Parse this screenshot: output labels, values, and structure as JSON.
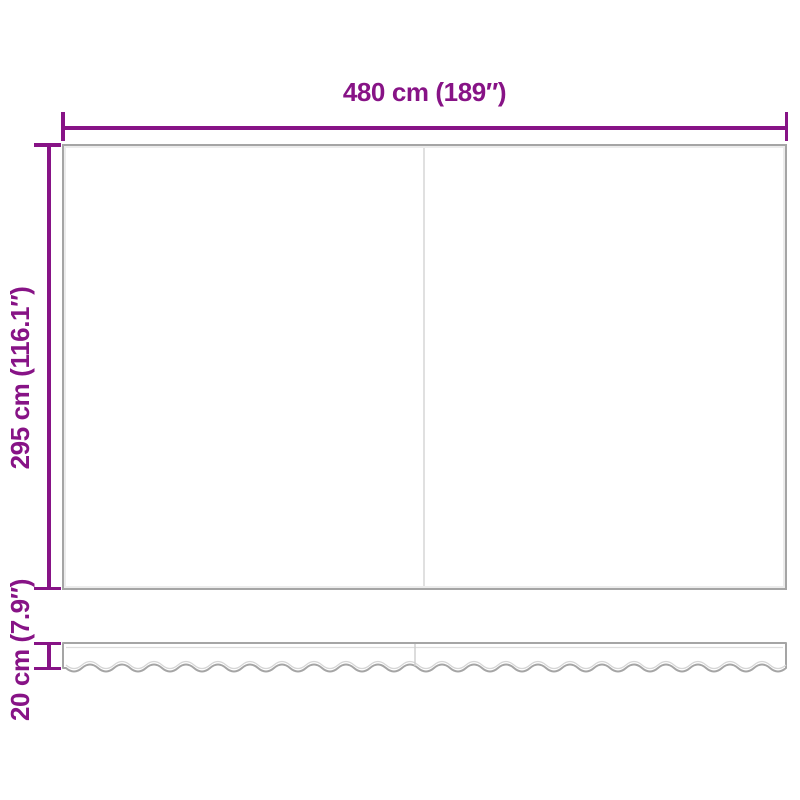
{
  "diagram": {
    "type": "product-dimension-diagram",
    "subject": "replacement awning fabric with wavy valance",
    "labels": {
      "width": "480 cm (189″)",
      "height": "295 cm (116.1″)",
      "valance_height": "20 cm (7.9″)"
    },
    "dimensions_cm": {
      "width": 480,
      "height": 295,
      "valance_height": 20
    }
  },
  "colors": {
    "dimension_accent": "#871386",
    "panel_outline": "#a5a5a5",
    "panel_inner": "#ececec",
    "seam_line": "#e0e0e0",
    "background": "#ffffff"
  }
}
